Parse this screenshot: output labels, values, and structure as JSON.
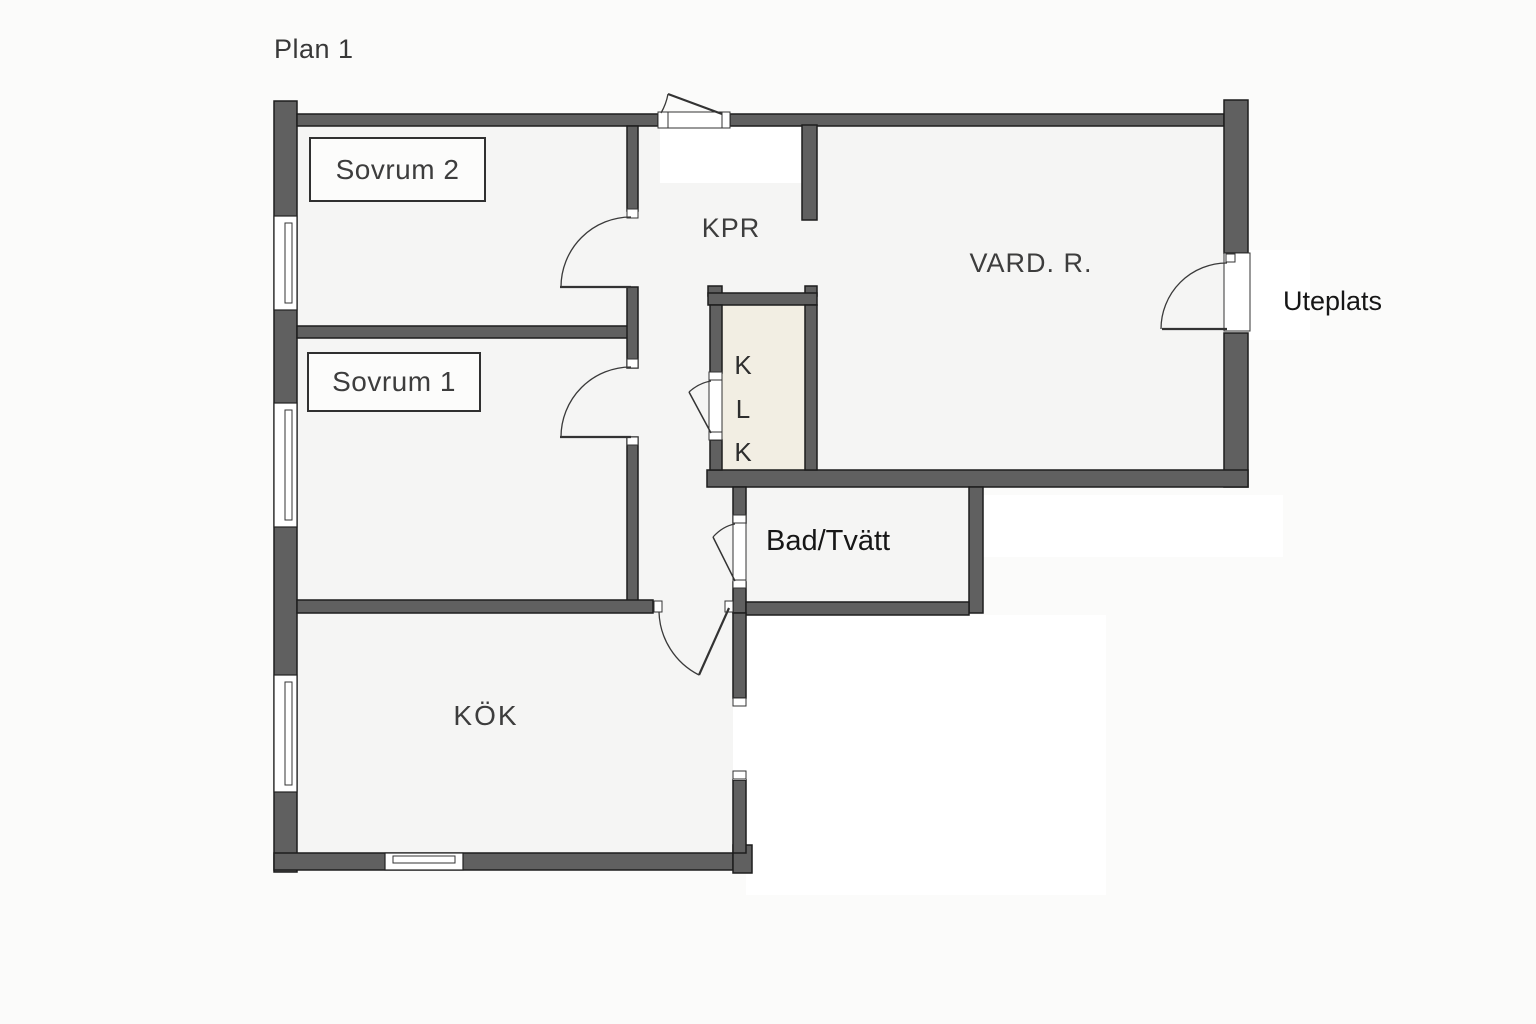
{
  "title": "Plan 1",
  "labels": {
    "sovrum2": "Sovrum 2",
    "sovrum1": "Sovrum 1",
    "kpr": "KPR",
    "vardagsrum": "VARD. R.",
    "klk": [
      "K",
      "L",
      "K"
    ],
    "bad_tvatt": "Bad/Tvätt",
    "kok": "KÖK",
    "uteplats": "Uteplats"
  },
  "colors": {
    "bg": "#fbfbfa",
    "floor": "#f5f5f4",
    "wall": "#606060",
    "outline": "#1d1d1d",
    "closet": "#f2eee3",
    "label": "#3d3d3d",
    "dark_label": "#161616",
    "line": "#333333"
  }
}
